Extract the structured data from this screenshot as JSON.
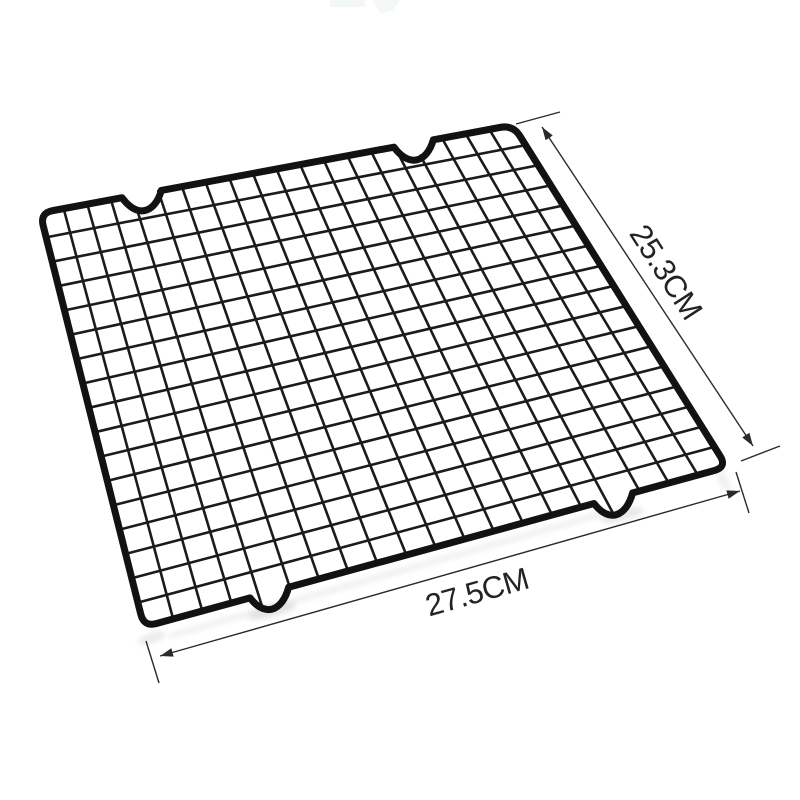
{
  "scene": {
    "subject": "black wire cooling rack product photo",
    "background": "#ffffff"
  },
  "annotations": {
    "depth_label": "25.3CM",
    "width_label": "27.5CM"
  },
  "colors": {
    "rim_wire": "#121212",
    "grid_wire": "#1b1b1b",
    "dimension_line": "#2b2b2b",
    "label_text": "#232323",
    "shadow": "#c9cdce",
    "artifact": "#f3f7f7"
  }
}
